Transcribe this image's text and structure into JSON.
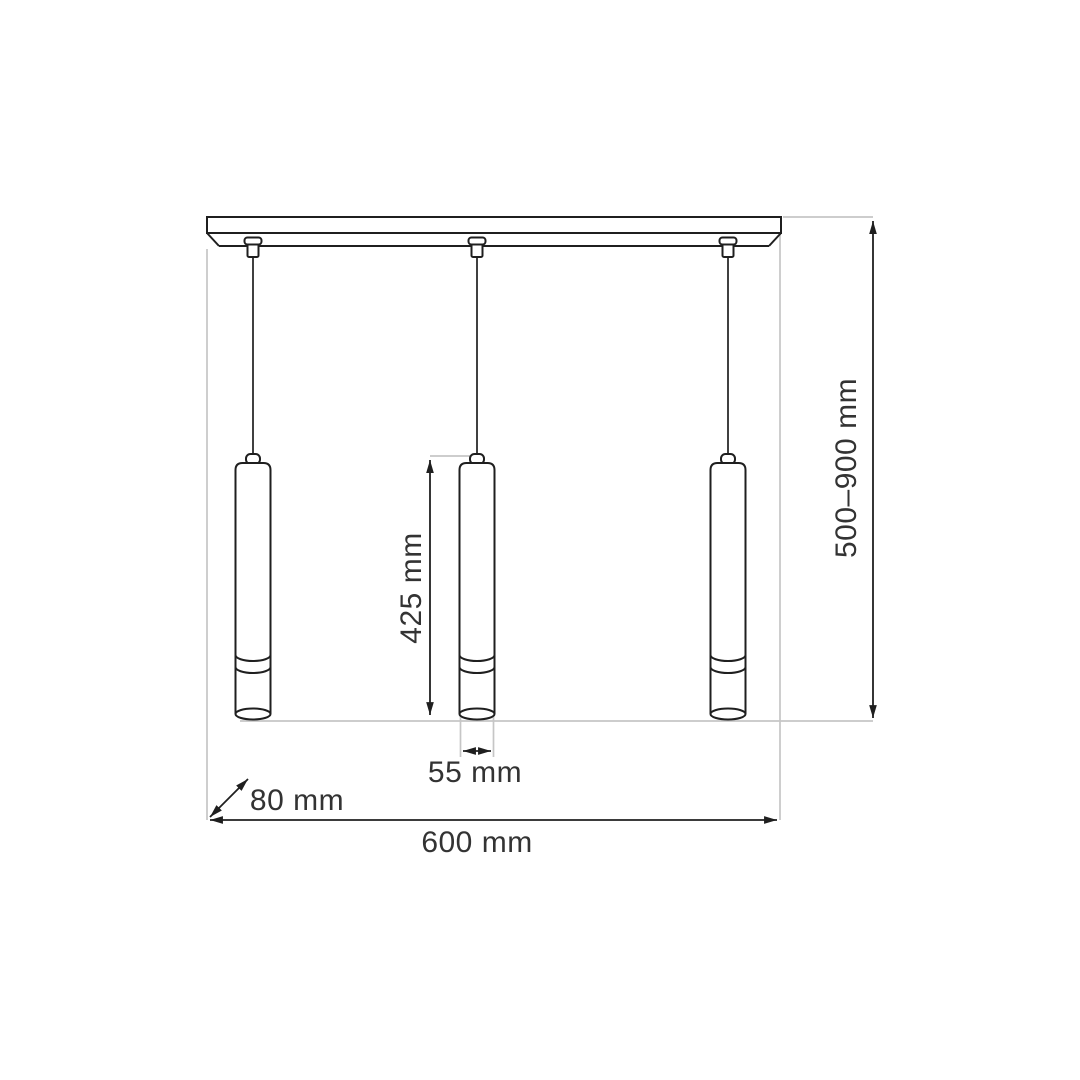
{
  "drawing": {
    "pendant_count": 3,
    "labels": {
      "width": "600 mm",
      "depth": "80 mm",
      "height_range": "500–900 mm",
      "shade_length": "425 mm",
      "shade_diameter": "55 mm"
    },
    "colors": {
      "outline": "#1f1f1f",
      "extension_line": "#c6c6c6",
      "label_text": "#333333",
      "background": "#ffffff"
    }
  }
}
